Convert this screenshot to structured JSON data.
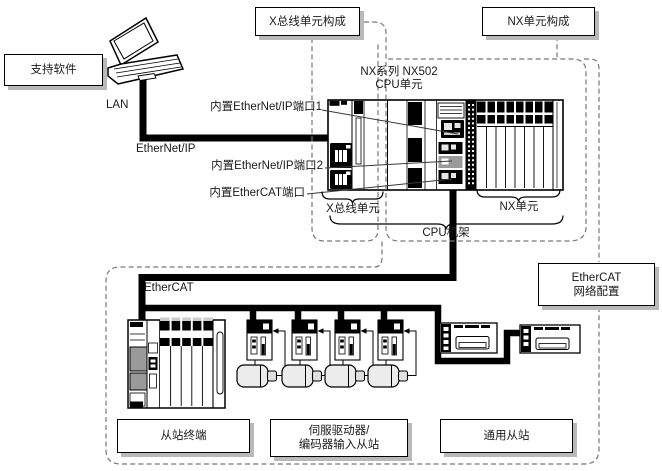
{
  "diagram": {
    "boxes": {
      "support_software": "支持软件",
      "xbus_config": "X总线单元构成",
      "nx_config": "NX单元构成",
      "ecat_network_line1": "EtherCAT",
      "ecat_network_line2": "网络配置",
      "slave_terminal": "从站终端",
      "servo_line1": "伺服驱动器/",
      "servo_line2": "编码器输入从站",
      "general_slave": "通用从站"
    },
    "labels": {
      "lan": "LAN",
      "ethernet_ip": "EtherNet/IP",
      "ethercat": "EtherCAT",
      "eip_port1": "内置EtherNet/IP端口1",
      "eip_port2": "内置EtherNet/IP端口2",
      "ecat_port": "内置EtherCAT端口",
      "cpu_title_line1": "NX系列 NX502",
      "cpu_title_line2": "CPU单元",
      "xbus_units": "X总线单元",
      "nx_units": "NX单元",
      "cpu_rack": "CPU机架"
    },
    "colors": {
      "line": "#000000",
      "dashed_line": "#777777",
      "box_border": "#000000",
      "box_shadow": "#b9b9b9",
      "text": "#1a1a1a",
      "background": "#ffffff"
    }
  }
}
